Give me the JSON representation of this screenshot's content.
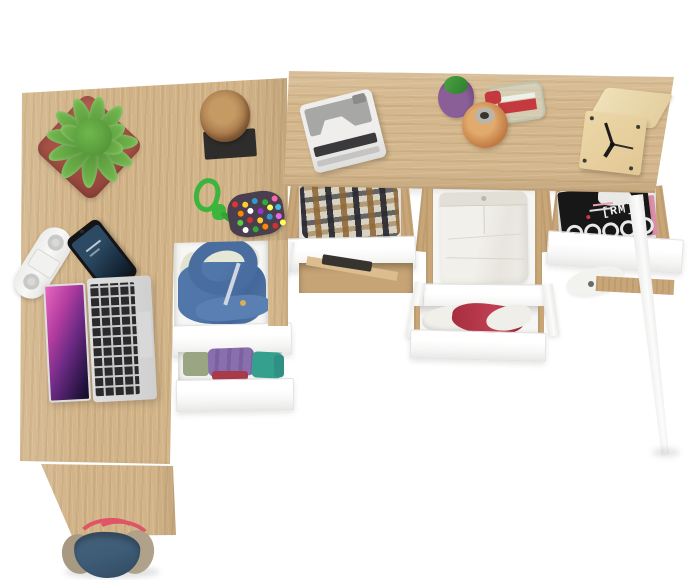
{
  "scene": {
    "description": "Overhead product view of two light-oak desks arranged in an L-shape; white drawers are pulled open revealing folded clothes, a blue hoodie and magazines; desk tops hold a laptop, smartphone, succulent plant, wood stump, beaded pouch, power strip, instant camera, perfume bottles and a wooden cube clock; a navy tote bag sits at the bottom edge",
    "background_color": "#ffffff"
  },
  "palette": {
    "oak": "#d3b58a",
    "oak_dark": "#c2a173",
    "oak_light": "#e3cda4",
    "drawer_white": "#fbfbfb",
    "plant_green": "#64a844",
    "pot_red": "#a9534a",
    "hoodie_blue": "#4f74a8",
    "pants_white": "#edebe4",
    "magazine_black": "#171717",
    "magazine_pink": "#dc8fa8",
    "bag_navy": "#3e5c77",
    "strap_red": "#e05565",
    "cloth_red": "#b23246",
    "cloth_purple": "#8a6fae",
    "cloth_teal": "#36a08f",
    "laptop_screen_pink": "#c84fae",
    "clock_wood": "#e7d1a0"
  },
  "desks": {
    "left_desk": {
      "label": "left oak desk",
      "surface_items": [
        "potted succulent in red pot",
        "wood stump on black mat",
        "multicolor beaded pouch with green cord",
        "white power strip",
        "black smartphone",
        "silver laptop with pink screen"
      ],
      "drawers": [
        "open drawer with blue hoodie",
        "open drawer with folded purple, teal and red clothes"
      ]
    },
    "top_desk": {
      "label": "top oak desk",
      "surface_items": [
        "white instant camera",
        "green perfume bottle",
        "amber perfume bottle",
        "clear perfume bottle with red cap",
        "wooden cube clock"
      ],
      "drawers": [
        "open drawer with plaid shirt",
        "empty drawer",
        "open drawer with folded white trousers",
        "open drawer with red and white cloth",
        "open drawer with magazines"
      ]
    }
  },
  "magazine": {
    "logo": "[RM]"
  },
  "bag": {
    "label": "navy tote bag with red straps"
  }
}
